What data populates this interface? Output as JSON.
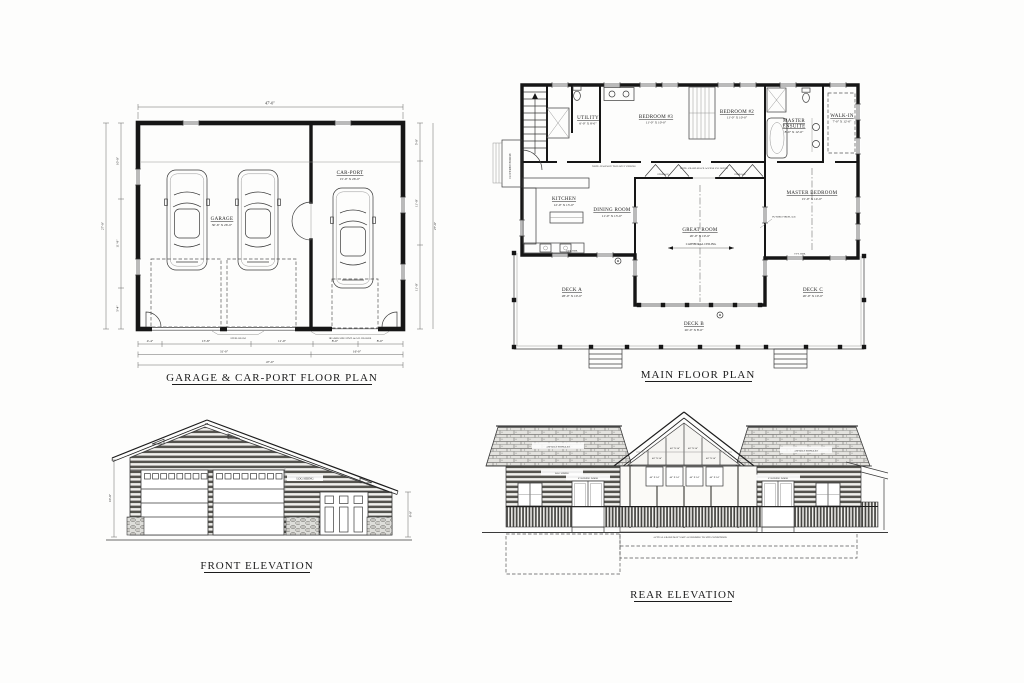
{
  "palette": {
    "paper": "#fdfdfc",
    "ink": "#1c1c1c",
    "line_gray": "#666666"
  },
  "garage_plan": {
    "title": "GARAGE & CAR-PORT FLOOR PLAN",
    "rooms": [
      {
        "name": "GARAGE",
        "dims": "30'-6\" X 26'-0\""
      },
      {
        "name": "CAR-PORT",
        "dims": "15'-0\" X 26'-0\""
      }
    ],
    "dimensions": {
      "overall_width_top": "47'-0\"",
      "overall_width_bottom": "47'-0\"",
      "garage_width": "31'-0\"",
      "carport_width": "16'-0\"",
      "front_chain": [
        "4'-4\"",
        "15'-8\"",
        "11'-0\"",
        "8'-0\"",
        "8'-0\""
      ],
      "left_chain": [
        "10'-0\"",
        "11'-8\"",
        "5'-4\""
      ],
      "right_chain": [
        "5'-0\"",
        "11'-0\"",
        "11'-0\""
      ],
      "left_total": "27'-0\"",
      "right_total": "27'-0\""
    },
    "notes": {
      "beam": "STEEL BEAM",
      "header": "HEADER SIZE STMT. & O.H. HEADER"
    }
  },
  "main_plan": {
    "title": "MAIN FLOOR PLAN",
    "rooms": [
      {
        "name": "UTILITY",
        "dims": "6'-0\" X 8'-0\""
      },
      {
        "name": "BEDROOM #3",
        "dims": "11'-0\" X 10'-0\""
      },
      {
        "name": "BEDROOM #2",
        "dims": "11'-0\" X 10'-0\""
      },
      {
        "name": "MASTER",
        "name2": "ENSUITE",
        "dims": "8'-0\" X 12'-0\""
      },
      {
        "name": "WALK-IN",
        "dims": "7'-0\" X 12'-0\""
      },
      {
        "name": "MASTER BEDROOM",
        "dims": "15'-0\" X 14'-0\""
      },
      {
        "name": "KITCHEN",
        "dims": "12'-0\" X 13'-0\""
      },
      {
        "name": "DINING ROOM",
        "dims": "11'-0\" X 13'-0\""
      },
      {
        "name": "GREAT ROOM",
        "dims": "20'-0\" X 19'-6\""
      },
      {
        "name": "DECK A",
        "dims": "28'-0\" X 10'-0\""
      },
      {
        "name": "DECK B",
        "dims": "20'-0\" X 8'-0\""
      },
      {
        "name": "DECK C",
        "dims": "20'-0\" X 10'-0\""
      }
    ],
    "labels": {
      "covered_porch": "COVERED PORCH",
      "storage": "STORAGE",
      "cathedral_ceiling": "CATHEDRAL CEILING",
      "ceiling_tag": "9 FT. HDR.",
      "future_fireplace": "FUTURE FIREPLACE"
    },
    "notes": {
      "hallway": "NOTE: HALLWAY TO HAVE 9' CEILING",
      "crawlspace": "NOTE: CRAWLSPACE ACCESS VIA HATCH"
    }
  },
  "front_elevation": {
    "title": "FRONT ELEVATION",
    "labels": {
      "siding": "LOG SIDING",
      "height_left": "10'-0\"",
      "height_right": "8'-0\""
    }
  },
  "rear_elevation": {
    "title": "REAR ELEVATION",
    "labels": {
      "shingles": "ASPHALT SHINGLES",
      "siding": "LOG SIDING",
      "sliding_door": "6' SLIDING DOOR",
      "window_size": "48\" X 34\"",
      "grade_note": "ACTUAL GRADE MAY VARY ACCORDING TO SITE CONDITIONS"
    }
  }
}
